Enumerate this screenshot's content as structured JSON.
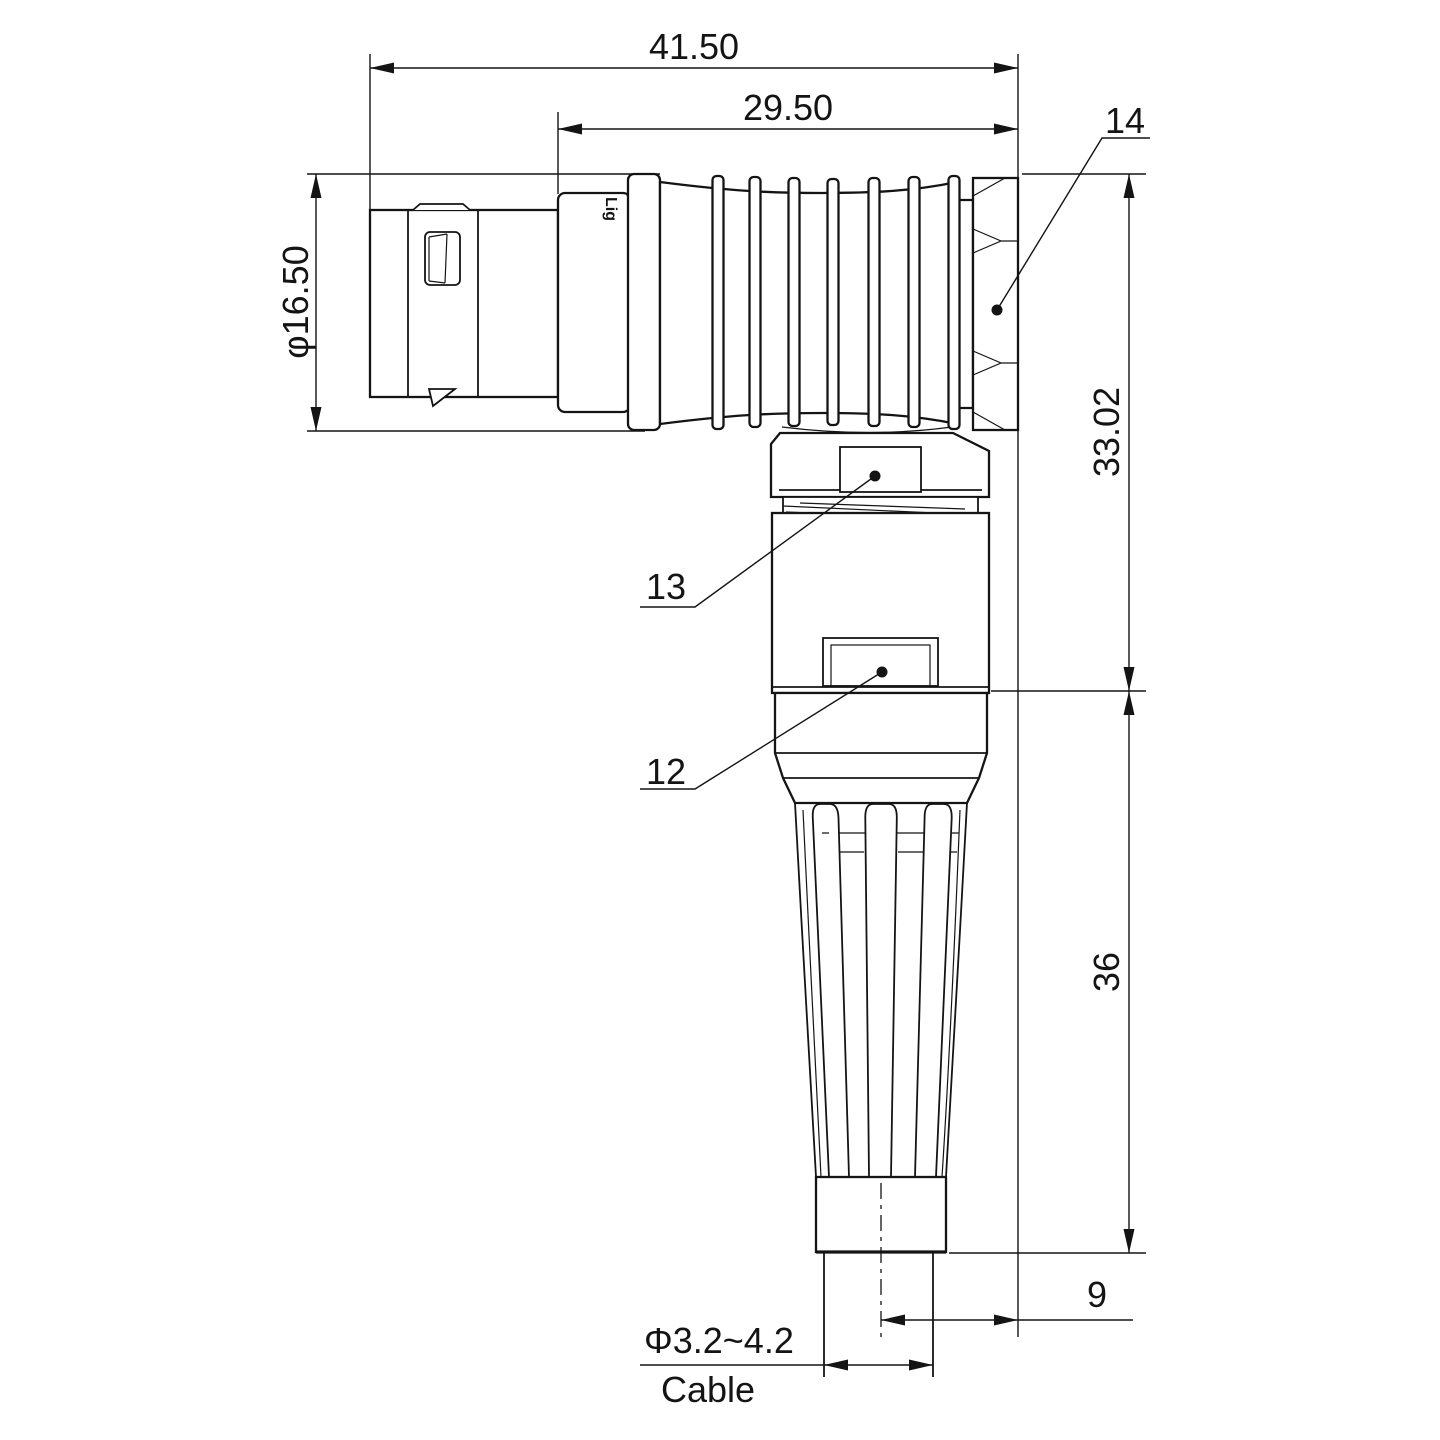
{
  "drawing": {
    "watermark": "Lightany",
    "brand_engraving": "Lig",
    "dimensions": {
      "overall_length": "41.50",
      "body_length": "29.50",
      "front_diameter": "φ16.50",
      "upper_height": "33.02",
      "lower_height": "36",
      "cable_stub": "9",
      "cable_diameter": "Φ3.2~4.2",
      "cable_label": "Cable"
    },
    "part_labels": {
      "backnut": "14",
      "collar_latch": "13",
      "body_latch": "12"
    },
    "colors": {
      "line": "#141414",
      "watermark": "#f4bcbc",
      "background": "#ffffff"
    }
  }
}
